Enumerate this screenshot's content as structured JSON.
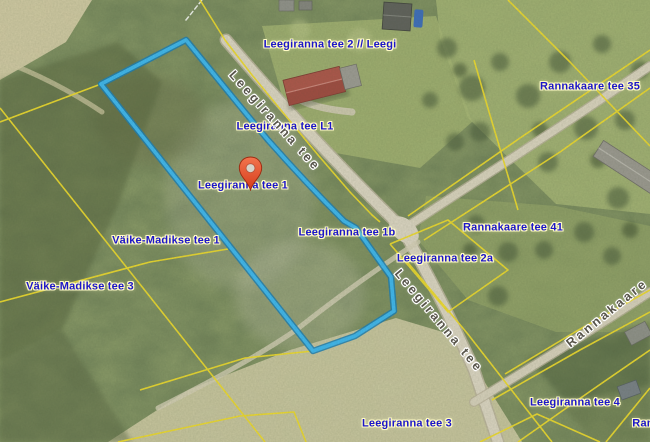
{
  "map": {
    "colors": {
      "selected_parcel": "#3fb6ec",
      "cadastral_line": "#ecd92e",
      "parcel_label_text": "#1c16c9",
      "label_halo": "#fffbc4",
      "road_label_text": "#57544a",
      "marker": "#e4512c"
    },
    "parcel_labels": [
      {
        "id": "leegiranna-tee-2-leegi",
        "text": "Leegiranna tee 2 // Leegi",
        "x": 330,
        "y": 45
      },
      {
        "id": "rannakaare-tee-35",
        "text": "Rannakaare tee 35",
        "x": 590,
        "y": 87
      },
      {
        "id": "leegiranna-tee-l1",
        "text": "Leegiranna tee L1",
        "x": 285,
        "y": 127
      },
      {
        "id": "leegiranna-tee-1",
        "text": "Leegiranna tee 1",
        "x": 243,
        "y": 186
      },
      {
        "id": "vaike-madikse-tee-1",
        "text": "Väike-Madikse tee 1",
        "x": 166,
        "y": 241
      },
      {
        "id": "leegiranna-tee-1b",
        "text": "Leegiranna tee 1b",
        "x": 347,
        "y": 233
      },
      {
        "id": "rannakaare-tee-41",
        "text": "Rannakaare tee 41",
        "x": 513,
        "y": 228
      },
      {
        "id": "leegiranna-tee-2a",
        "text": "Leegiranna tee 2a",
        "x": 445,
        "y": 259
      },
      {
        "id": "vaike-madikse-tee-3",
        "text": "Väike-Madikse tee 3",
        "x": 80,
        "y": 287
      },
      {
        "id": "leegiranna-tee-4",
        "text": "Leegiranna tee 4",
        "x": 575,
        "y": 403
      },
      {
        "id": "leegiranna-tee-3",
        "text": "Leegiranna tee 3",
        "x": 407,
        "y": 424
      },
      {
        "id": "rannakaare-partial",
        "text": "Ran",
        "x": 643,
        "y": 424
      }
    ],
    "road_labels": [
      {
        "id": "leegiranna-tee-road-upper",
        "text": "Leegiranna tee",
        "x": 275,
        "y": 121,
        "angle": 48
      },
      {
        "id": "leegiranna-tee-road-lower",
        "text": "Leegiranna tee",
        "x": 439,
        "y": 321,
        "angle": 50
      },
      {
        "id": "rannakaare-road",
        "text": "Rannakaare",
        "x": 607,
        "y": 313,
        "angle": -39
      }
    ],
    "marker": {
      "x": 250,
      "y": 191
    }
  }
}
